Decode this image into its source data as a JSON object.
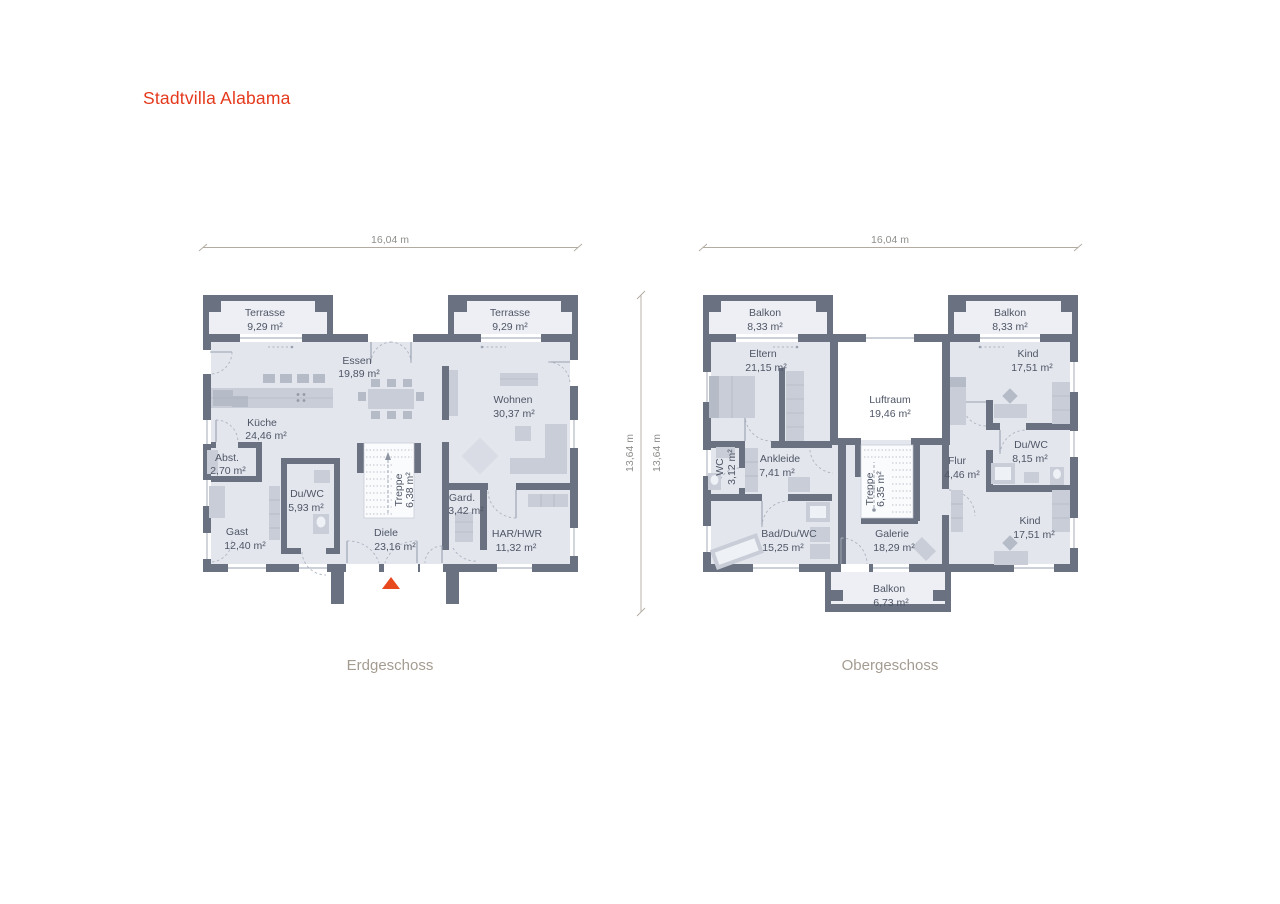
{
  "title": "Stadtvilla Alabama",
  "colors": {
    "accent": "#e5391c",
    "wall": "#6a7180",
    "floor": "#e3e6ed",
    "balcony_floor": "#edeff4",
    "furniture": "#c9cdd7",
    "room_text": "#4e5565",
    "dimension_text": "#8f8e8b",
    "caption_text": "#a49c91"
  },
  "dims": {
    "w": "16,04 m",
    "h": "13,64 m"
  },
  "floors": {
    "eg": {
      "caption": "Erdgeschoss",
      "rooms": {
        "terrasse_l": {
          "name": "Terrasse",
          "area": "9,29 m²"
        },
        "terrasse_r": {
          "name": "Terrasse",
          "area": "9,29 m²"
        },
        "essen": {
          "name": "Essen",
          "area": "19,89 m²"
        },
        "kueche": {
          "name": "Küche",
          "area": "24,46 m²"
        },
        "abst": {
          "name": "Abst.",
          "area": "2,70 m²"
        },
        "gast": {
          "name": "Gast",
          "area": "12,40 m²"
        },
        "du_wc": {
          "name": "Du/WC",
          "area": "5,93 m²"
        },
        "diele": {
          "name": "Diele",
          "area": "23,16 m²"
        },
        "treppe": {
          "name": "Treppe",
          "area": "6,38 m²"
        },
        "gard": {
          "name": "Gard.",
          "area": "3,42 m²"
        },
        "har_hwr": {
          "name": "HAR/HWR",
          "area": "11,32 m²"
        },
        "wohnen": {
          "name": "Wohnen",
          "area": "30,37 m²"
        }
      }
    },
    "og": {
      "caption": "Obergeschoss",
      "rooms": {
        "balkon_l": {
          "name": "Balkon",
          "area": "8,33 m²"
        },
        "balkon_r": {
          "name": "Balkon",
          "area": "8,33 m²"
        },
        "eltern": {
          "name": "Eltern",
          "area": "21,15 m²"
        },
        "kind_o": {
          "name": "Kind",
          "area": "17,51 m²"
        },
        "luftraum": {
          "name": "Luftraum",
          "area": "19,46 m²"
        },
        "wc": {
          "name": "WC",
          "area": "3,12 m²"
        },
        "ankleide": {
          "name": "Ankleide",
          "area": "7,41 m²"
        },
        "du_wc": {
          "name": "Du/WC",
          "area": "8,15 m²"
        },
        "flur": {
          "name": "Flur",
          "area": "4,46 m²"
        },
        "treppe": {
          "name": "Treppe",
          "area": "6,35 m²"
        },
        "bad_du_wc": {
          "name": "Bad/Du/WC",
          "area": "15,25 m²"
        },
        "galerie": {
          "name": "Galerie",
          "area": "18,29 m²"
        },
        "kind_u": {
          "name": "Kind",
          "area": "17,51 m²"
        },
        "balkon_u": {
          "name": "Balkon",
          "area": "6,73 m²"
        }
      }
    }
  }
}
